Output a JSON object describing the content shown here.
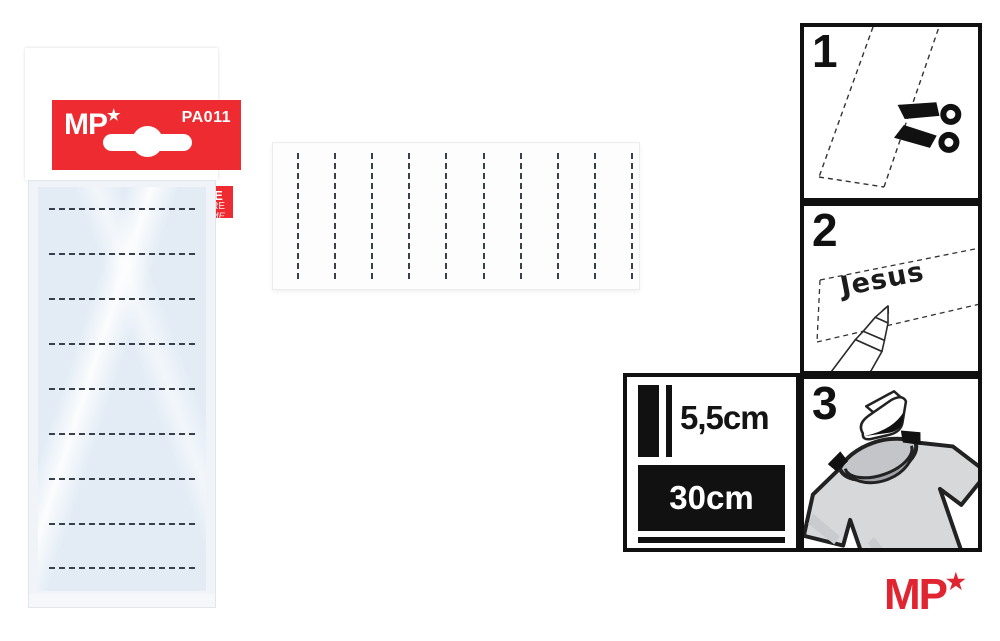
{
  "package": {
    "brand": "MP",
    "brand_star": "★",
    "product_code": "PA011",
    "title": "THERMAL TAPE NAME",
    "subtitle_es": "CINTA TÉRMICA NOMBRE",
    "subtitle_it": "NASTRO TERMICO PER NOME",
    "tape_line_count": 9
  },
  "strip": {
    "segment_line_count": 10
  },
  "steps": [
    {
      "number": "1",
      "icon": "scissors-icon"
    },
    {
      "number": "2",
      "icon": "marker-pen-icon",
      "sample_text": "Jesus"
    },
    {
      "number": "3",
      "icon": "iron-icon"
    }
  ],
  "dimensions": {
    "width_label": "5,5cm",
    "length_label": "30cm"
  },
  "footer": {
    "brand": "MP",
    "brand_star": "★"
  },
  "colors": {
    "brand_red": "#ee2b31",
    "footer_red": "#e02531",
    "tape_blue": "#e3ecf5",
    "shirt_gray": "#d7d8da",
    "ink_black": "#111111"
  }
}
